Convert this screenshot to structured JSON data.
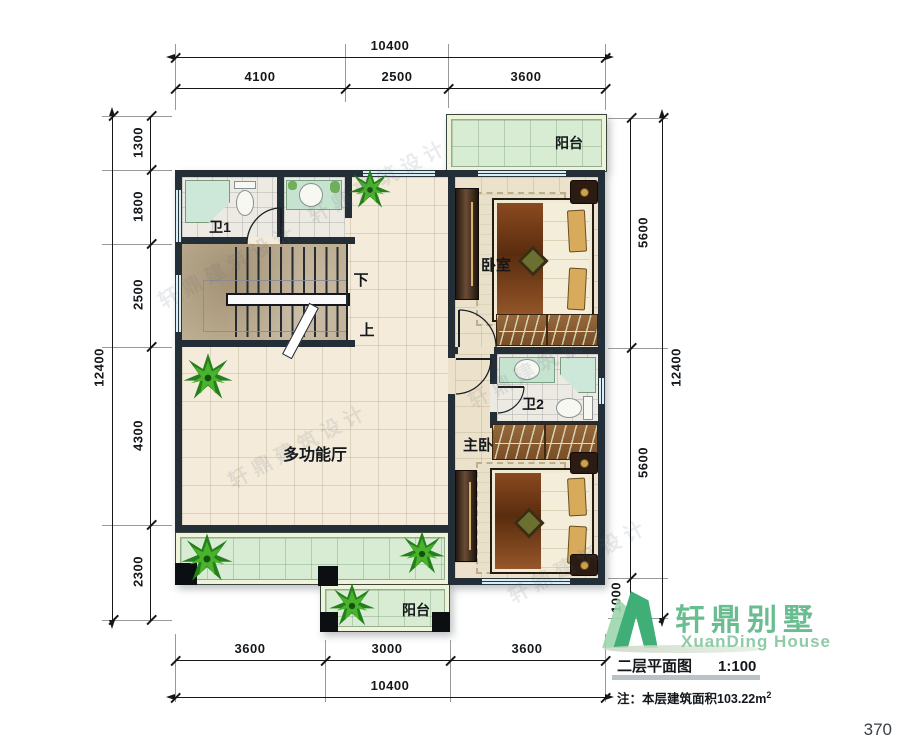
{
  "page": {
    "number": "370"
  },
  "watermark": {
    "text": "轩鼎建筑设计"
  },
  "plan": {
    "rooms": {
      "balcony_top": "阳台",
      "bath1": "卫1",
      "bedroom": "卧室",
      "bath2": "卫2",
      "master": "主卧",
      "hall": "多功能厅",
      "balcony_bottom": "阳台",
      "stair_down": "下",
      "stair_up": "上"
    }
  },
  "dimensions": {
    "top": {
      "overall": "10400",
      "segments": [
        "4100",
        "2500",
        "3600"
      ]
    },
    "bottom": {
      "overall": "10400",
      "segments": [
        "3600",
        "3000",
        "3600"
      ]
    },
    "left": {
      "overall": "12400",
      "segments": [
        "1300",
        "1800",
        "2500",
        "4300",
        "2300"
      ]
    },
    "right": {
      "overall": "12400",
      "segments": [
        "5600",
        "5600",
        "1000"
      ]
    }
  },
  "title_block": {
    "brand_cn": "轩鼎别墅",
    "brand_en": "XuanDing House",
    "drawing_title": "二层平面图",
    "scale": "1:100",
    "note_prefix": "注：",
    "note_body": "本层建筑面积103.22m",
    "note_sup": "2"
  },
  "colors": {
    "wall": "#232e37",
    "hall_tile": "#f4ebdb",
    "bath_tile": "#eceae2",
    "bedroom_floor": "#ece2cc",
    "stair_floor": "#beae92",
    "balcony_tile": "#d7ecd2",
    "window": "#d9eef2",
    "brand_green": "#69bd90",
    "logo_dark": "#3fae77",
    "logo_light": "#9bd6ac"
  }
}
